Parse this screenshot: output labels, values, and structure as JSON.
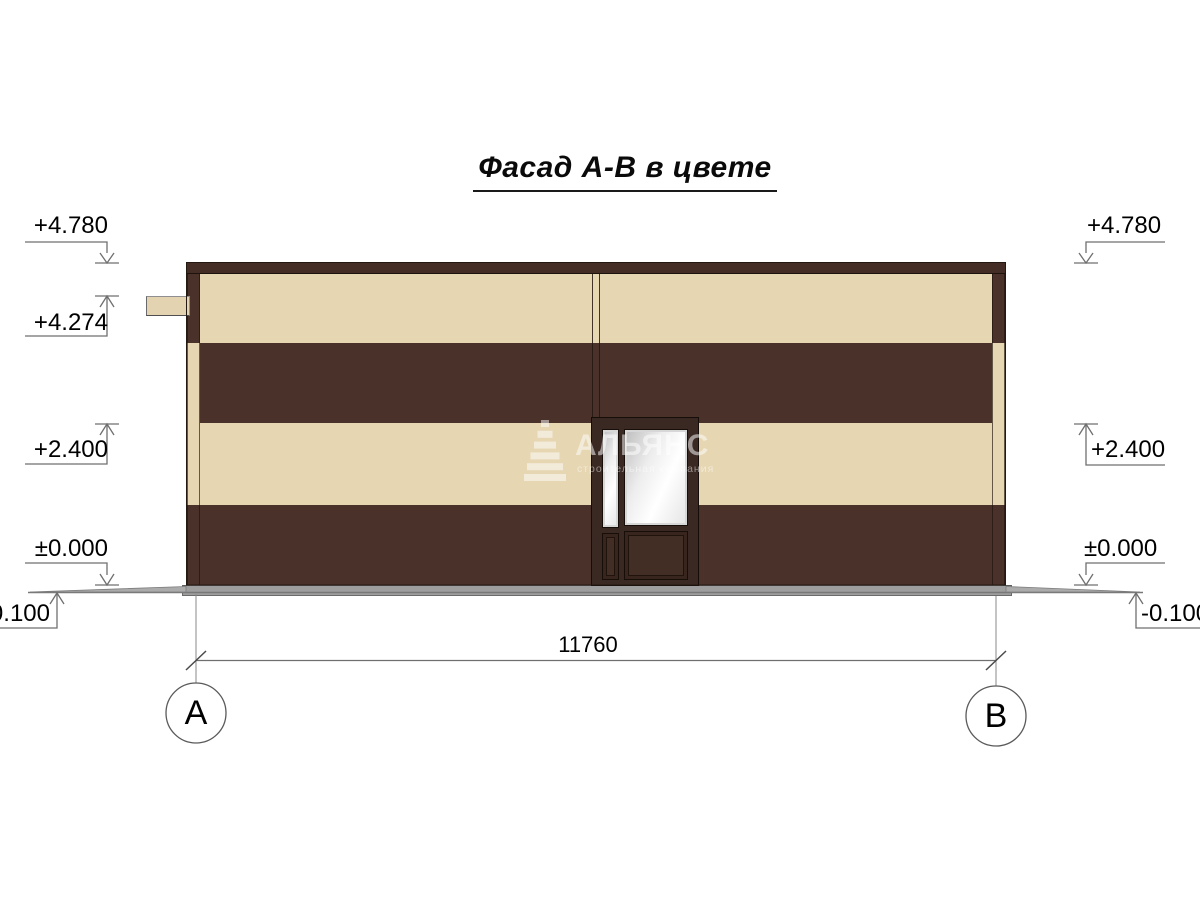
{
  "title": "Фасад А-В в цвете",
  "levels": {
    "left": [
      "+4.780",
      "+4.274",
      "+2.400",
      "±0.000",
      "-0.100"
    ],
    "right": [
      "+4.780",
      "+2.400",
      "±0.000",
      "-0.100"
    ]
  },
  "dimension_total": "11760",
  "axes": {
    "left": "А",
    "right": "В"
  },
  "watermark": {
    "name": "АЛЬЯНС",
    "tagline": "строительная компания"
  },
  "colors": {
    "facade_cream": "#e6d6b2",
    "facade_dark_brown": "#4a322a",
    "cornice_brown": "#442d25",
    "door_frame_brown": "#3a2822",
    "plinth_gray": "#9e9e9e",
    "annotation_line_gray": "#6f6f6f"
  }
}
